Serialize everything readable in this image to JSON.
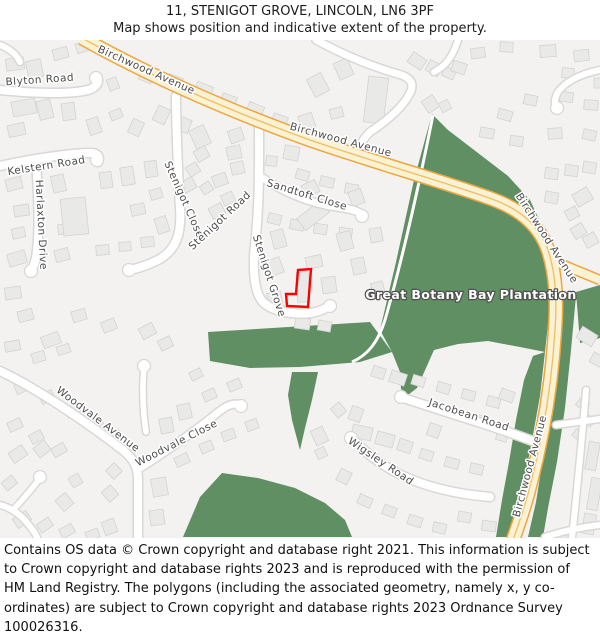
{
  "header": {
    "title": "11, STENIGOT GROVE, LINCOLN, LN6 3PF",
    "subtitle": "Map shows position and indicative extent of the property."
  },
  "map": {
    "street_labels": [
      {
        "slug": "birchwood-avenue-nw",
        "text": "Birchwood Avenue",
        "x": 145,
        "y": 73,
        "rotate": 24
      },
      {
        "slug": "birchwood-avenue-n",
        "text": "Birchwood Avenue",
        "x": 340,
        "y": 143,
        "rotate": 15
      },
      {
        "slug": "birchwood-avenue-e",
        "text": "Birchwood Avenue",
        "x": 544,
        "y": 240,
        "rotate": 57
      },
      {
        "slug": "birchwood-avenue-s",
        "text": "Birchwood Avenue",
        "x": 533,
        "y": 467,
        "rotate": -75
      },
      {
        "slug": "blyton-road",
        "text": "Blyton Road",
        "x": 40,
        "y": 83,
        "rotate": -4
      },
      {
        "slug": "kelstern-road",
        "text": "Kelstern Road",
        "x": 47,
        "y": 169,
        "rotate": -9
      },
      {
        "slug": "harlaxton-drive",
        "text": "Harlaxton Drive",
        "x": 38,
        "y": 225,
        "rotate": 87
      },
      {
        "slug": "stenigot-close",
        "text": "Stenigot Close",
        "x": 181,
        "y": 201,
        "rotate": 66
      },
      {
        "slug": "stenigot-road",
        "text": "Stenigot Road",
        "x": 222,
        "y": 223,
        "rotate": -43
      },
      {
        "slug": "stenigot-grove",
        "text": "Stenigot Grove",
        "x": 266,
        "y": 277,
        "rotate": 72
      },
      {
        "slug": "sandtoft-close",
        "text": "Sandtoft Close",
        "x": 306,
        "y": 198,
        "rotate": 17
      },
      {
        "slug": "woodvale-avenue",
        "text": "Woodvale Avenue",
        "x": 96,
        "y": 422,
        "rotate": 37
      },
      {
        "slug": "woodvale-close",
        "text": "Woodvale Close",
        "x": 178,
        "y": 446,
        "rotate": -27
      },
      {
        "slug": "jacobean-road",
        "text": "Jacobean Road",
        "x": 468,
        "y": 418,
        "rotate": 18
      },
      {
        "slug": "wigsley-road",
        "text": "Wigsley Road",
        "x": 379,
        "y": 464,
        "rotate": 34
      }
    ],
    "area_labels": [
      {
        "slug": "great-botany-bay-plantation",
        "text": "Great Botany Bay Plantation",
        "x": 471,
        "y": 299
      }
    ],
    "property_marker": {
      "color": "#ff0000"
    },
    "colors": {
      "background": "#f3f2f0",
      "building": "#e9e9e8",
      "building_outline": "#d3d3d1",
      "road_minor": "#ffffff",
      "road_minor_casing": "#d8d8d6",
      "road_primary": "#fbf2d4",
      "road_primary_casing": "#eca63e",
      "road_primary_centerline": "#f0bd62",
      "woodland": "#5f8f62",
      "street_label": "#4c4c4c"
    }
  },
  "footer": {
    "text": "Contains OS data © Crown copyright and database right 2021. This information is subject to Crown copyright and database rights 2023 and is reproduced with the permission of HM Land Registry. The polygons (including the associated geometry, namely x, y co-ordinates) are subject to Crown copyright and database rights 2023 Ordnance Survey 100026316."
  }
}
